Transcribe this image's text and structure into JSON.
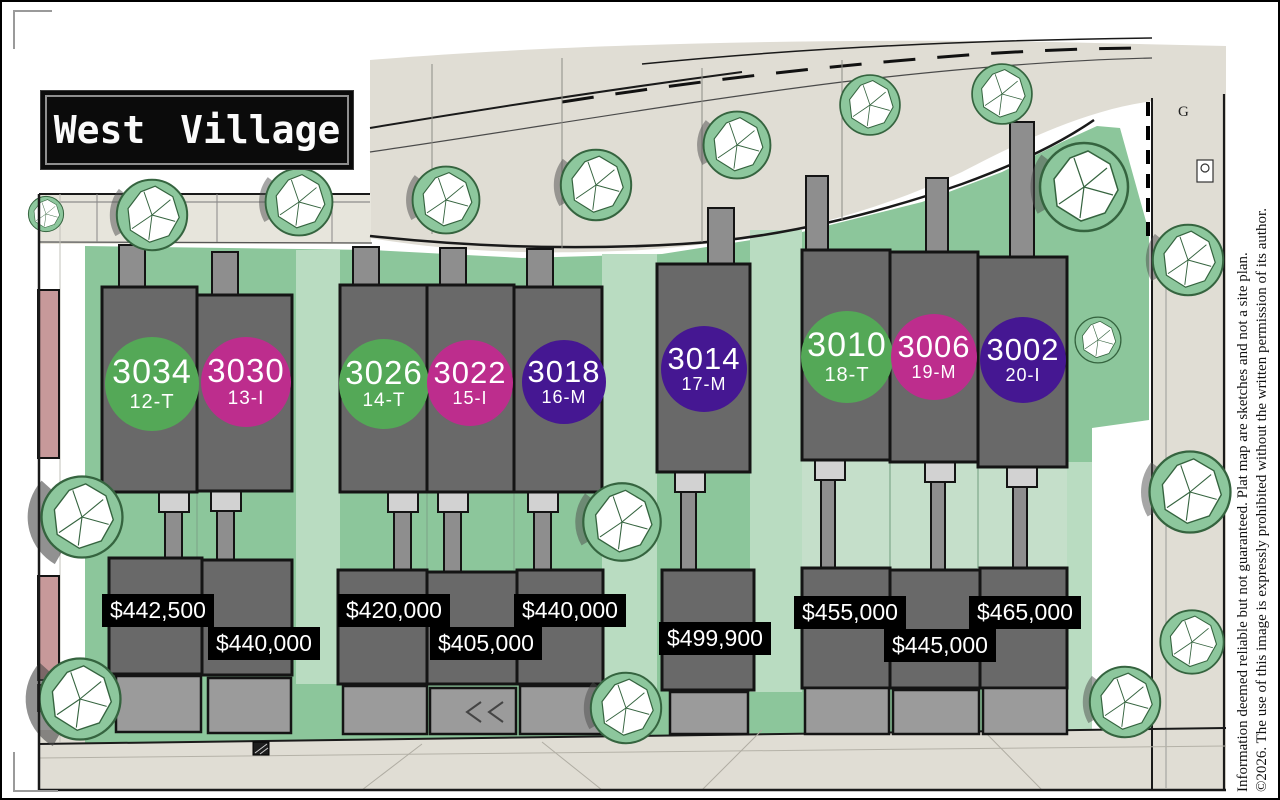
{
  "sign": {
    "title": "West Village"
  },
  "road_label": "G",
  "colors": {
    "green": "#54a857",
    "magenta": "#bd2d8d",
    "purple": "#451792"
  },
  "lots": [
    {
      "address": "3034",
      "lot": "12-T",
      "color": "green",
      "price": "$442,500"
    },
    {
      "address": "3030",
      "lot": "13-I",
      "color": "magenta",
      "price": "$440,000"
    },
    {
      "address": "3026",
      "lot": "14-T",
      "color": "green",
      "price": "$420,000"
    },
    {
      "address": "3022",
      "lot": "15-I",
      "color": "magenta",
      "price": "$405,000"
    },
    {
      "address": "3018",
      "lot": "16-M",
      "color": "purple",
      "price": "$440,000"
    },
    {
      "address": "3014",
      "lot": "17-M",
      "color": "purple",
      "price": "$499,900"
    },
    {
      "address": "3010",
      "lot": "18-T",
      "color": "green",
      "price": "$455,000"
    },
    {
      "address": "3006",
      "lot": "19-M",
      "color": "magenta",
      "price": "$445,000"
    },
    {
      "address": "3002",
      "lot": "20-I",
      "color": "purple",
      "price": "$465,000"
    }
  ],
  "disclaimer": {
    "line1": "Information deemed reliable but not guaranteed. Plat map are sketches and not a site plan.",
    "line2": "©2026. The use of this image is expressly prohibited without the written permission of its author."
  }
}
